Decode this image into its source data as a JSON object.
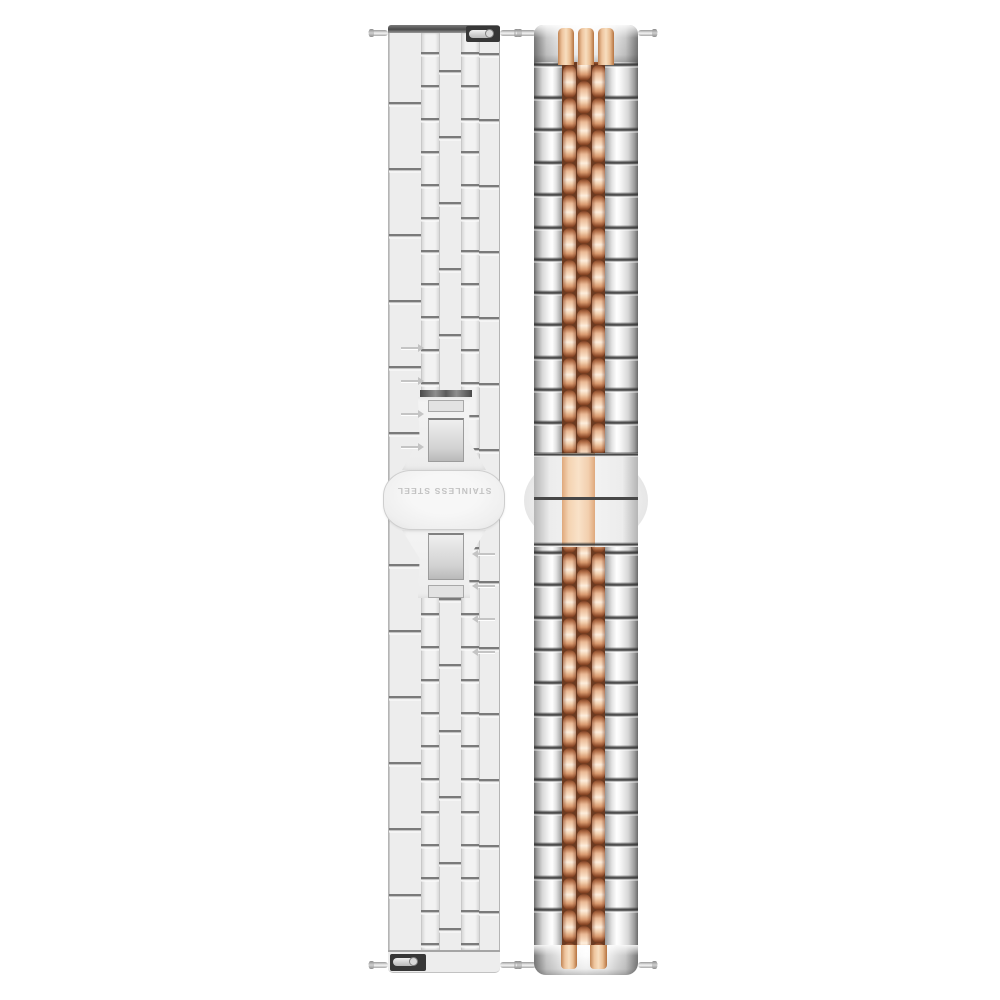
{
  "scene": {
    "type": "product photo",
    "background": "#ffffff",
    "subject": "Two stainless steel watch bands side by side"
  },
  "left_band": {
    "finish": "brushed silver",
    "columns": 5,
    "clasp_text": "STAINLESS STEEL",
    "clasp_style": "butterfly deployant clasp, back view, text rotated 180 degrees"
  },
  "right_band": {
    "style": "jubilee",
    "finish": "two-tone: silver outer links, rose gold center links",
    "center_columns": 3
  },
  "colors": {
    "background": "#ffffff",
    "silver_base": "#ededed",
    "silver_bright": "#fafafa",
    "silver_line": "#b5b5b5",
    "silver_edge_dark": "#6f6f6f",
    "groove_dark": "#343434",
    "end_bar_dark": "#4a4a4a",
    "rose_dark": "#7e4023",
    "rose_mid": "#d99a6f",
    "rose_light": "#f9ddc3",
    "rose_highlight": "#fdeedd",
    "rose_flat": "#f4d3b2",
    "rose_gap": "#6b3a20",
    "clasp_text_color": "#c2c2c2"
  }
}
